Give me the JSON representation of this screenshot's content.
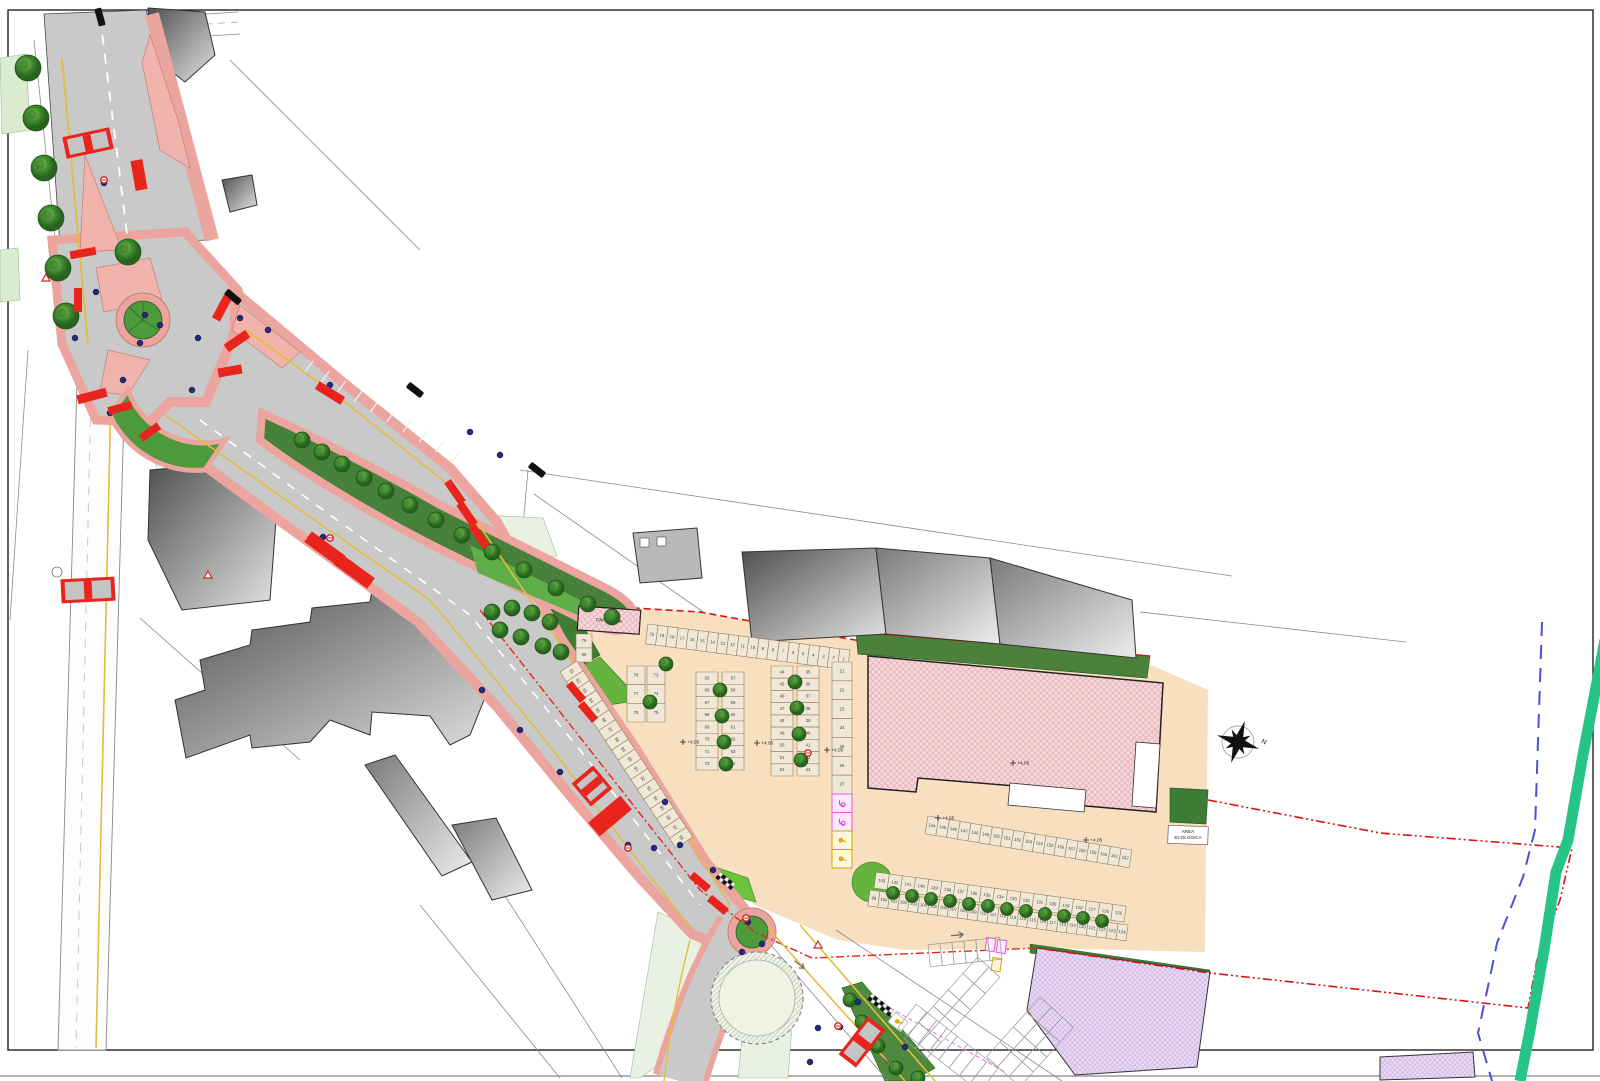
{
  "meta": {
    "type": "urban-site-plan"
  },
  "labels": {
    "area_ecologica_line1": "AREA",
    "area_ecologica_line2": "ECOLOGICA",
    "capolinea": "CAPOLINEA",
    "north_letter": "N",
    "elevation_marker": "+4.05"
  },
  "parking": {
    "row_top": [
      "20",
      "19",
      "18",
      "17",
      "16",
      "15",
      "14",
      "13",
      "12",
      "11",
      "10",
      "9",
      "8",
      "7",
      "6",
      "5",
      "4",
      "3",
      "2",
      "1"
    ],
    "col_right": [
      "21",
      "22",
      "23",
      "24",
      "25",
      "26",
      "27"
    ],
    "col_right_disabled": [
      "28",
      "29"
    ],
    "col_right_service": [
      "30",
      "31"
    ],
    "cluster_a_left": [
      "78",
      "77",
      "76"
    ],
    "cluster_a_right": [
      "73",
      "74",
      "75"
    ],
    "cluster_b_left": [
      "65",
      "66",
      "67",
      "68",
      "69",
      "70",
      "71",
      "72"
    ],
    "cluster_b_right": [
      "57",
      "58",
      "59",
      "60",
      "61",
      "62",
      "63",
      "64"
    ],
    "cluster_c_left": [
      "44",
      "45",
      "46",
      "47",
      "48",
      "49",
      "50",
      "51",
      "52"
    ],
    "cluster_c_right": [
      "35",
      "36",
      "37",
      "38",
      "39",
      "40",
      "41",
      "42",
      "43"
    ],
    "row_roadside_top": [
      "79",
      "80"
    ],
    "row_roadside": [
      "81",
      "82",
      "83",
      "84",
      "85",
      "86",
      "87",
      "88",
      "89",
      "90",
      "91",
      "92",
      "93",
      "94",
      "95",
      "96",
      "97",
      "98"
    ],
    "row_building_front": [
      "144",
      "145",
      "146",
      "147",
      "148",
      "149",
      "150",
      "151",
      "152",
      "153",
      "154",
      "155",
      "156",
      "157",
      "158",
      "159",
      "160",
      "161",
      "162"
    ],
    "row_south_upper": [
      "143",
      "142",
      "141",
      "140",
      "139",
      "138",
      "137",
      "136",
      "135",
      "134",
      "133",
      "132",
      "131",
      "130",
      "129",
      "128",
      "127",
      "126",
      "125"
    ],
    "row_south_lower": [
      "99",
      "100",
      "101",
      "102",
      "103",
      "104",
      "105",
      "106",
      "107",
      "108",
      "109",
      "110",
      "111",
      "112",
      "113",
      "114",
      "115",
      "116",
      "117",
      "118",
      "119",
      "120",
      "121",
      "122",
      "123",
      "124"
    ]
  },
  "colors": {
    "road_gray": "#c9c9c9",
    "sidewalk_pink": "#eba49e",
    "island_salmon": "#f0b4ad",
    "marking_red": "#e8241c",
    "grass_dark": "#3f7d33",
    "grass_mid": "#579d42",
    "grass_bright": "#6cc43d",
    "grass_pale": "#e9f2e2",
    "lot_tan": "#f8dfc0",
    "building_pink": "#f6d7db",
    "parcel_lavender": "#ead9f5",
    "boundary_red": "#dd1111",
    "ditch_blue": "#4a50d8",
    "stream_green": "#27c488",
    "lane_yellow": "#e3bc3f",
    "lamp_navy": "#232a7c"
  }
}
